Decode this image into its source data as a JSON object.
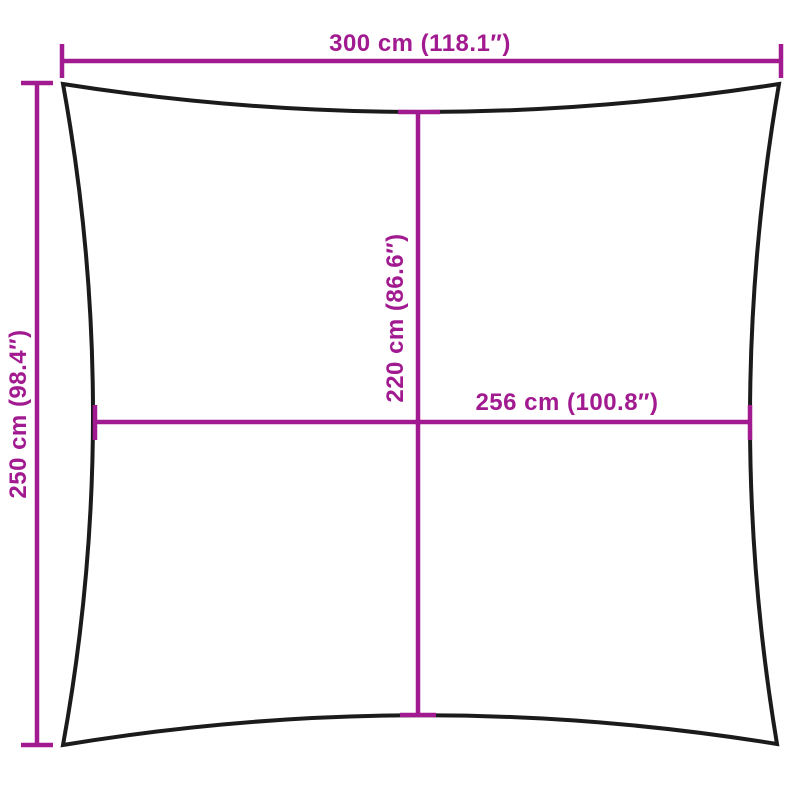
{
  "diagram": {
    "colors": {
      "dimension_accent": "#A21A8F",
      "outline": "#1B1B1B",
      "background": "#FFFFFF"
    },
    "dimensions": {
      "outer_width": {
        "label": "300 cm (118.1″)",
        "cm": 300,
        "inches": 118.1
      },
      "outer_height": {
        "label": "250 cm (98.4″)",
        "cm": 250,
        "inches": 98.4
      },
      "inner_height": {
        "label": "220 cm (86.6″)",
        "cm": 220,
        "inches": 86.6
      },
      "inner_width": {
        "label": "256 cm (100.8″)",
        "cm": 256,
        "inches": 100.8
      }
    }
  }
}
